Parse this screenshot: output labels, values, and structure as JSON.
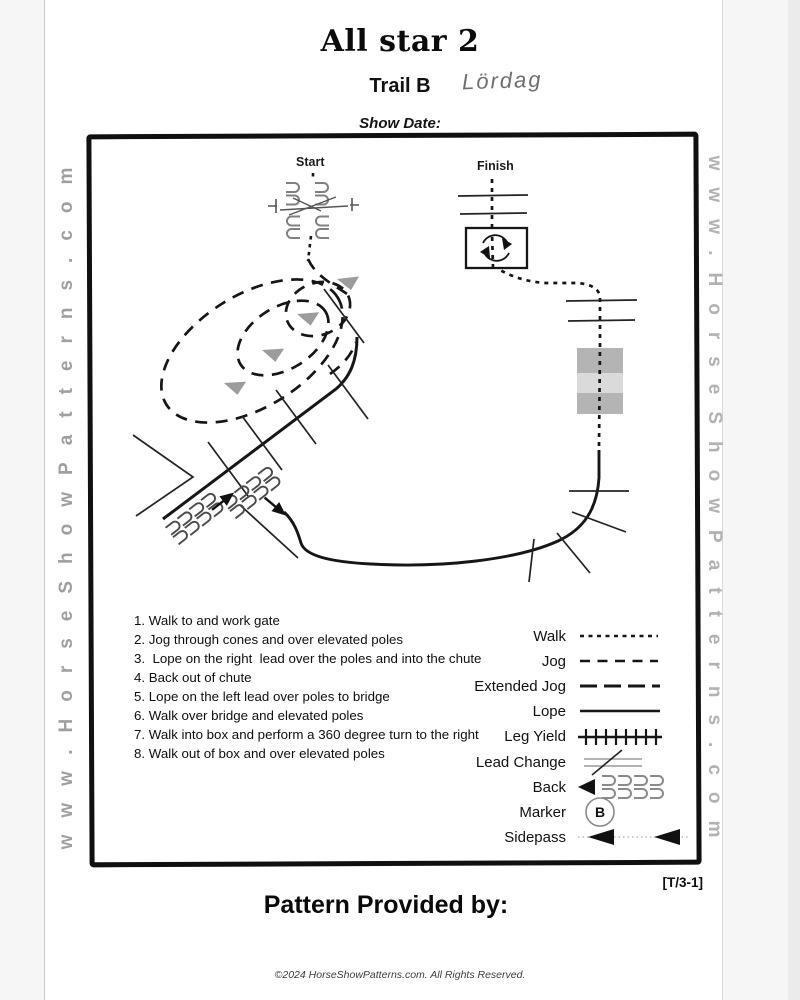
{
  "page": {
    "title": "All star 2",
    "subtitle": "Trail B",
    "handwritten_note": "Lördag",
    "show_date_label": "Show Date:",
    "pattern_code": "[T/3-1]",
    "footer_heading": "Pattern Provided by:",
    "copyright": "©2024 HorseShowPatterns.com. All Rights Reserved."
  },
  "watermarks": {
    "left": "www.HorseShowPatterns.com",
    "right": "www.HorseShowPatterns.com"
  },
  "diagram": {
    "start_label": "Start",
    "finish_label": "Finish",
    "colors": {
      "ink": "#161616",
      "gray_symbol": "#808080",
      "direction_arrow": "#9c9c9c",
      "bridge": "#b4b4b4",
      "bridge_stripe": "#dadada"
    }
  },
  "instructions": {
    "items": [
      "1. Walk to and work gate",
      "2. Jog through cones and over elevated poles",
      "3.  Lope on the right  lead over the poles and into the chute",
      "4. Back out of chute",
      "5. Lope on the left lead over poles to bridge",
      "6. Walk over bridge and elevated poles",
      "7. Walk into box and perform a 360 degree turn to the right",
      "8. Walk out of box and over elevated poles"
    ]
  },
  "legend": {
    "items": [
      {
        "label": "Walk",
        "type": "walk-dotted-line"
      },
      {
        "label": "Jog",
        "type": "jog-dashed-line"
      },
      {
        "label": "Extended Jog",
        "type": "extended-jog-long-dash-line"
      },
      {
        "label": "Lope",
        "type": "lope-solid-line"
      },
      {
        "label": "Leg Yield",
        "type": "leg-yield-crosshatch-line"
      },
      {
        "label": "Lead Change",
        "type": "lead-change-slashed-lines"
      },
      {
        "label": "Back",
        "type": "back-arrow-poles"
      },
      {
        "label": "Marker",
        "type": "marker-circle",
        "letter": "B"
      },
      {
        "label": "Sidepass",
        "type": "sidepass-arrows"
      }
    ]
  }
}
